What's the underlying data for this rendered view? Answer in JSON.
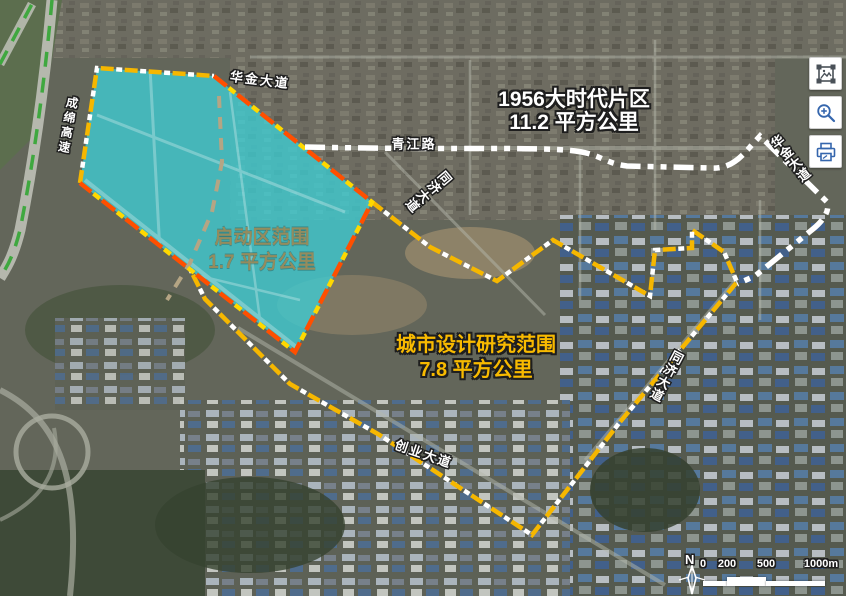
{
  "regions": {
    "district1956": {
      "title": "1956大时代片区",
      "area": "11.2 平方公里",
      "boundary_color": "#ffffff"
    },
    "launch": {
      "title": "启动区范围",
      "area": "1.7 平方公里",
      "boundary_color": "#ff4f00",
      "fill_color": "#3ecdd3"
    },
    "research": {
      "title": "城市设计研究范围",
      "area": "7.8 平方公里",
      "boundary_color": "#f6b700"
    }
  },
  "roads": {
    "huajin_top": "华金大道",
    "qingjiang": "青江路",
    "tongji_mid": "同济大道",
    "tongji_right": "同济大道",
    "huajin_right": "华金大道",
    "chengmian": "成绵高速",
    "chuangye": "创业大道"
  },
  "toolbar": {
    "buttons": [
      {
        "id": "export-image",
        "icon": "image-frame-icon",
        "color": "#4a5158"
      },
      {
        "id": "zoom-in",
        "icon": "magnifier-plus-icon",
        "color": "#3566ad"
      },
      {
        "id": "print",
        "icon": "printer-icon",
        "color": "#3566ad"
      }
    ]
  },
  "scalebar": {
    "north": "N",
    "ticks": [
      "0",
      "200",
      "500",
      "1000m"
    ]
  },
  "colors": {
    "expressway_dash": "#3fa83f",
    "internal_dashed_road": "#b5a584",
    "research_dash_alt": "#ffffff",
    "launch_dash_alt": "#ffd800"
  }
}
